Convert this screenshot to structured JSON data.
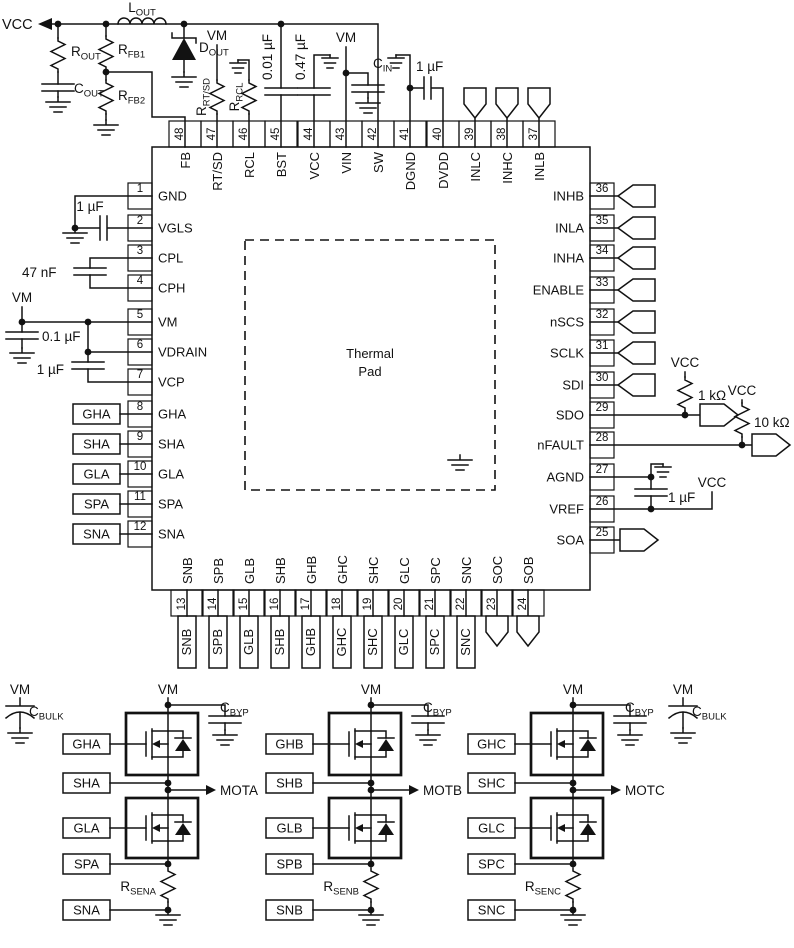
{
  "title": "Gate driver IC typical application schematic",
  "colors": {
    "line": "#121212",
    "background": "#ffffff"
  },
  "chip": {
    "thermal_pad_line1": "Thermal",
    "thermal_pad_line2": "Pad"
  },
  "pins": {
    "top": [
      {
        "num": "48",
        "name": "FB"
      },
      {
        "num": "47",
        "name": "RT/SD"
      },
      {
        "num": "46",
        "name": "RCL"
      },
      {
        "num": "45",
        "name": "BST"
      },
      {
        "num": "44",
        "name": "VCC"
      },
      {
        "num": "43",
        "name": "VIN"
      },
      {
        "num": "42",
        "name": "SW"
      },
      {
        "num": "41",
        "name": "DGND"
      },
      {
        "num": "40",
        "name": "DVDD"
      },
      {
        "num": "39",
        "name": "INLC"
      },
      {
        "num": "38",
        "name": "INHC"
      },
      {
        "num": "37",
        "name": "INLB"
      }
    ],
    "left": [
      {
        "num": "1",
        "name": "GND"
      },
      {
        "num": "2",
        "name": "VGLS"
      },
      {
        "num": "3",
        "name": "CPL"
      },
      {
        "num": "4",
        "name": "CPH"
      },
      {
        "num": "5",
        "name": "VM"
      },
      {
        "num": "6",
        "name": "VDRAIN"
      },
      {
        "num": "7",
        "name": "VCP"
      },
      {
        "num": "8",
        "name": "GHA"
      },
      {
        "num": "9",
        "name": "SHA"
      },
      {
        "num": "10",
        "name": "GLA"
      },
      {
        "num": "11",
        "name": "SPA"
      },
      {
        "num": "12",
        "name": "SNA"
      }
    ],
    "right": [
      {
        "num": "36",
        "name": "INHB"
      },
      {
        "num": "35",
        "name": "INLA"
      },
      {
        "num": "34",
        "name": "INHA"
      },
      {
        "num": "33",
        "name": "ENABLE"
      },
      {
        "num": "32",
        "name": "nSCS"
      },
      {
        "num": "31",
        "name": "SCLK"
      },
      {
        "num": "30",
        "name": "SDI"
      },
      {
        "num": "29",
        "name": "SDO"
      },
      {
        "num": "28",
        "name": "nFAULT"
      },
      {
        "num": "27",
        "name": "AGND"
      },
      {
        "num": "26",
        "name": "VREF"
      },
      {
        "num": "25",
        "name": "SOA"
      }
    ],
    "bottom": [
      {
        "num": "13",
        "name": "SNB"
      },
      {
        "num": "14",
        "name": "SPB"
      },
      {
        "num": "15",
        "name": "GLB"
      },
      {
        "num": "16",
        "name": "SHB"
      },
      {
        "num": "17",
        "name": "GHB"
      },
      {
        "num": "18",
        "name": "GHC"
      },
      {
        "num": "19",
        "name": "SHC"
      },
      {
        "num": "20",
        "name": "GLC"
      },
      {
        "num": "21",
        "name": "SPC"
      },
      {
        "num": "22",
        "name": "SNC"
      },
      {
        "num": "23",
        "name": "SOC"
      },
      {
        "num": "24",
        "name": "SOB"
      }
    ]
  },
  "top_circuit": {
    "vcc_label": "VCC",
    "l_out": {
      "main": "L",
      "sub": "OUT"
    },
    "r_out": {
      "main": "R",
      "sub": "OUT"
    },
    "c_out": {
      "main": "C",
      "sub": "OUT"
    },
    "r_fb1": {
      "main": "R",
      "sub": "FB1"
    },
    "r_fb2": {
      "main": "R",
      "sub": "FB2"
    },
    "d_out": {
      "main": "D",
      "sub": "OUT"
    },
    "vm_rtsd": "VM",
    "r_rtsd": {
      "main": "R",
      "sub": "RT/SD"
    },
    "r_rcl": {
      "main": "R",
      "sub": "RCL"
    },
    "c_bst": "0.01 µF",
    "c_vcc": "0.47 µF",
    "vm_vin": "VM",
    "c_in": {
      "main": "C",
      "sub": "IN"
    },
    "c_dvdd": "1 µF"
  },
  "left_circuit": {
    "c_vgls": "1 µF",
    "c_cp": "47 nF",
    "vm_label": "VM",
    "c_vm": "0.1 µF",
    "c_vcp": "1 µF",
    "net_labels": [
      "GHA",
      "SHA",
      "GLA",
      "SPA",
      "SNA"
    ]
  },
  "right_circuit": {
    "vcc_sdo": "VCC",
    "r_sdo": "1 kΩ",
    "vcc_nfault": "VCC",
    "r_nfault": "10 kΩ",
    "c_agnd": "1 µF",
    "vcc_vref": "VCC"
  },
  "bottom_net_labels": [
    "SNB",
    "SPB",
    "GLB",
    "SHB",
    "GHB",
    "GHC",
    "SHC",
    "GLC",
    "SPC",
    "SNC"
  ],
  "bridges": [
    {
      "vm": "VM",
      "cbyp": {
        "main": "C",
        "sub": "BYP"
      },
      "gh": "GHA",
      "sh": "SHA",
      "gl": "GLA",
      "sp": "SPA",
      "sn": "SNA",
      "mot": "MOTA",
      "rsen": {
        "main": "R",
        "sub": "SENA"
      }
    },
    {
      "vm": "VM",
      "cbyp": {
        "main": "C",
        "sub": "BYP"
      },
      "gh": "GHB",
      "sh": "SHB",
      "gl": "GLB",
      "sp": "SPB",
      "sn": "SNB",
      "mot": "MOTB",
      "rsen": {
        "main": "R",
        "sub": "SENB"
      }
    },
    {
      "vm": "VM",
      "cbyp": {
        "main": "C",
        "sub": "BYP"
      },
      "gh": "GHC",
      "sh": "SHC",
      "gl": "GLC",
      "sp": "SPC",
      "sn": "SNC",
      "mot": "MOTC",
      "rsen": {
        "main": "R",
        "sub": "SENC"
      }
    }
  ],
  "bulk_caps": [
    {
      "vm": "VM",
      "label": {
        "main": "C",
        "sub": "BULK"
      }
    },
    {
      "vm": "VM",
      "label": {
        "main": "C",
        "sub": "BULK"
      }
    }
  ]
}
